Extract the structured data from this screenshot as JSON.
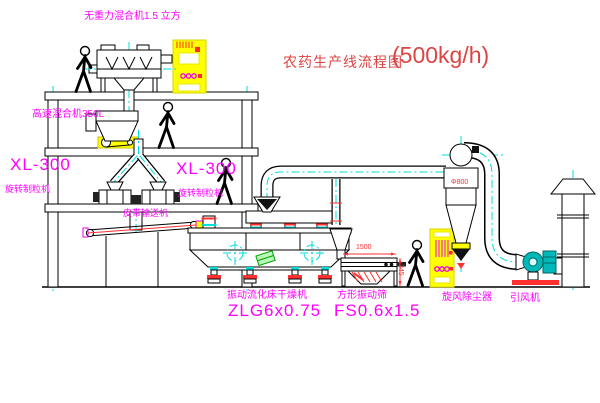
{
  "diagram": {
    "title": "农药生产线流程图",
    "capacity": "(500kg/h)"
  },
  "equipment_labels": {
    "gravity_mixer": "无重力混合机1.5 立方",
    "high_speed_mixer": "高速混合机350L",
    "granulator_left_model": "XL-300",
    "granulator_left_name": "旋转制粒机",
    "granulator_right_model": "XL-300",
    "granulator_right_name": "旋转制粒机",
    "belt_conveyor": "皮带输送机",
    "fluid_bed_dryer_name": "振动流化床干燥机",
    "fluid_bed_dryer_model": "ZLG6x0.75",
    "vibrating_sieve_name": "方形振动筛",
    "vibrating_sieve_model": "FS0.6x1.5",
    "cyclone": "旋风除尘器",
    "draft_fan": "引风机"
  },
  "dimensions": {
    "sieve_length": "1500",
    "sieve_height": "345",
    "cyclone_diameter": "Φ800"
  },
  "colors": {
    "background": "#ffffff",
    "line": "#000000",
    "centerline": "#00dcdc",
    "label_text": "#ff00ff",
    "title_text": "#dd4444",
    "dimension_text": "#ff3030",
    "cabinet_fill": "#ffff00",
    "fan_fill": "#00b8b8",
    "motor_box_fill": "#b9f7b9"
  }
}
